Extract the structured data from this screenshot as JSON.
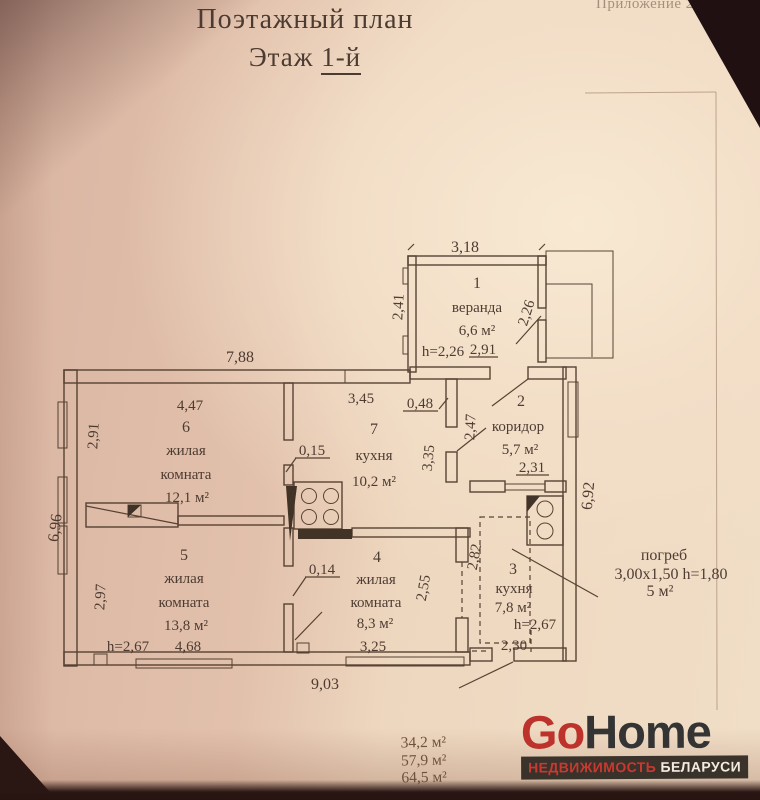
{
  "document": {
    "annotation": "Приложение 2",
    "title": "Поэтажный план",
    "floor_label": "Этаж",
    "floor_value": "1-й"
  },
  "plan": {
    "rooms": {
      "veranda": {
        "num": "1",
        "name": "веранда",
        "area": "6,6 м²",
        "height": "h=2,26"
      },
      "corridor": {
        "num": "2",
        "name": "коридор",
        "area": "5,7 м²"
      },
      "kitchen3": {
        "num": "3",
        "name": "кухня",
        "area": "7,8 м²",
        "height": "h=2,67"
      },
      "room4": {
        "num": "4",
        "line1": "жилая",
        "line2": "комната",
        "area": "8,3 м²"
      },
      "room5": {
        "num": "5",
        "line1": "жилая",
        "line2": "комната",
        "area": "13,8 м²",
        "height": "h=2,67"
      },
      "room6": {
        "num": "6",
        "line1": "жилая",
        "line2": "комната",
        "area": "12,1 м²"
      },
      "kitchen7": {
        "num": "7",
        "name": "кухня",
        "area": "10,2 м²"
      }
    },
    "cellar": {
      "name": "погреб",
      "size": "3,00х1,50 h=1,80",
      "area": "5 м²"
    },
    "dims": {
      "veranda_width": "3,18",
      "veranda_left": "2,41",
      "veranda_door": "2,26",
      "corridor_top": "2,91",
      "house_top": "7,88",
      "room6_top": "4,47",
      "room6_left": "2,91",
      "kitchen7_top": "3,45",
      "kitchen7_jamb": "0,48",
      "partition_upper": "0,15",
      "corridor_left": "2,47",
      "kitchen7_right": "3,35",
      "corridor_bottom": "2,31",
      "house_left": "6,96",
      "house_right": "6,92",
      "room5_left": "2,97",
      "room5_bottom": "4,68",
      "partition_lower": "0,14",
      "room4_bottom": "3,25",
      "room4_right": "2,55",
      "kitchen3_left": "2,82",
      "kitchen3_bottom": "2,30",
      "house_bottom": "9,03"
    },
    "totals": [
      "34,2 м²",
      "57,9 м²",
      "64,5 м²"
    ]
  },
  "watermark": {
    "brand_go": "Go",
    "brand_home": "Home",
    "tagline_red": "НЕДВИЖИМОСТЬ",
    "tagline_white": " БЕЛАРУСИ",
    "brand_red_color": "#bd332c"
  }
}
